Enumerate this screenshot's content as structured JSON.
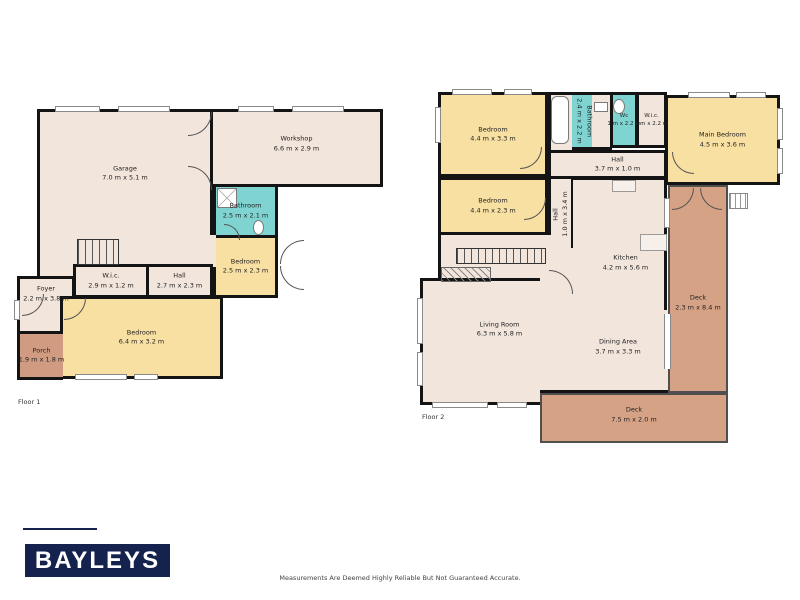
{
  "branding": {
    "logo": "BAYLEYS"
  },
  "disclaimer": "Measurements Are Deemed Highly Reliable But Not Guaranteed Accurate.",
  "colors": {
    "floor": "#f2e5dc",
    "bedroom": "#f8dfa2",
    "bath": "#7fd4d1",
    "porch": "#d09b80",
    "deck": "#d6a285",
    "wall": "#141414",
    "deck_wall": "#4f4f4f",
    "logo_bg": "#14224d"
  },
  "floors": [
    {
      "label": "Floor 1",
      "label_pos": [
        18,
        398
      ],
      "rooms": [
        {
          "name": "Garage",
          "dims": "7.0 m x 5.1 m",
          "fill": "floor",
          "rect": [
            37,
            109,
            176,
            129
          ]
        },
        {
          "name": "Workshop",
          "dims": "6.6 m x 2.9 m",
          "fill": "floor",
          "rect": [
            210,
            109,
            173,
            78
          ],
          "dy": -4
        },
        {
          "name": "Bathroom",
          "dims": "2.5 m x 2.1 m",
          "fill": "bath",
          "rect": [
            213,
            184,
            65,
            54
          ]
        },
        {
          "name": "Bedroom",
          "dims": "2.5 m x 2.3 m",
          "fill": "bedroom",
          "rect": [
            213,
            235,
            65,
            63
          ]
        },
        {
          "name": "",
          "dims": "",
          "fill": "floor",
          "rect": [
            37,
            235,
            179,
            32
          ],
          "sides": "l"
        },
        {
          "name": "",
          "dims": "",
          "fill": "floor",
          "rect": [
            37,
            264,
            39,
            36
          ],
          "sides": "l"
        },
        {
          "name": "W.i.c.",
          "dims": "2.9 m x 1.2 m",
          "fill": "floor",
          "rect": [
            73,
            264,
            76,
            34
          ]
        },
        {
          "name": "Hall",
          "dims": "2.7 m x 2.3 m",
          "fill": "floor",
          "rect": [
            146,
            264,
            67,
            34
          ]
        },
        {
          "name": "Foyer",
          "dims": "2.2 m x 3.8 m",
          "fill": "floor",
          "rect": [
            17,
            276,
            58,
            58
          ],
          "dy": -11
        },
        {
          "name": "Bedroom",
          "dims": "6.4 m x 3.2 m",
          "fill": "bedroom",
          "rect": [
            60,
            296,
            163,
            83
          ]
        },
        {
          "name": "Porch",
          "dims": "1.9 m x 1.8 m",
          "fill": "porch",
          "rect": [
            17,
            331,
            46,
            49
          ],
          "sides": "ltb"
        }
      ]
    },
    {
      "label": "Floor 2",
      "label_pos": [
        422,
        413
      ],
      "rooms": [
        {
          "name": "Bedroom",
          "dims": "4.4 m x 3.3 m",
          "fill": "bedroom",
          "rect": [
            438,
            92,
            110,
            85
          ]
        },
        {
          "name": "",
          "dims": "",
          "fill": "floor",
          "rect": [
            548,
            92,
            27,
            58
          ],
          "sides": "tl"
        },
        {
          "name": "Bathroom",
          "dims": "2.4 m x 2.2 m",
          "fill": "bath",
          "rect": [
            572,
            92,
            23,
            58
          ],
          "sides": "tb",
          "vertical": true
        },
        {
          "name": "",
          "dims": "",
          "fill": "floor",
          "rect": [
            592,
            92,
            20,
            58
          ],
          "sides": "tb"
        },
        {
          "name": "Wc",
          "dims": "1 m x 2.2 m",
          "fill": "bath",
          "rect": [
            610,
            92,
            28,
            56
          ],
          "small": true
        },
        {
          "name": "W.i.c.",
          "dims": "1 m x 2.2 m",
          "fill": "floor",
          "rect": [
            636,
            92,
            31,
            56
          ],
          "small": true
        },
        {
          "name": "Main Bedroom",
          "dims": "4.5 m x 3.6 m",
          "fill": "bedroom",
          "rect": [
            665,
            95,
            115,
            90
          ]
        },
        {
          "name": "Hall",
          "dims": "3.7 m x 1.0 m",
          "fill": "floor",
          "rect": [
            548,
            150,
            119,
            29
          ],
          "dx": 10
        },
        {
          "name": "Bedroom",
          "dims": "4.4 m x 2.3 m",
          "fill": "bedroom",
          "rect": [
            438,
            177,
            110,
            58
          ]
        },
        {
          "name": "Hall",
          "dims": "1.0 m x 3.4 m",
          "fill": "floor",
          "rect": [
            548,
            179,
            26,
            70
          ],
          "sides": "lr",
          "vertical": true,
          "flip": true
        },
        {
          "name": "Kitchen",
          "dims": "4.2 m x 5.6 m",
          "fill": "floor",
          "rect": [
            573,
            177,
            94,
            133
          ],
          "sides": "tr",
          "dx": 7,
          "dy": 18
        },
        {
          "name": "",
          "dims": "",
          "fill": "floor",
          "rect": [
            438,
            235,
            113,
            45
          ],
          "sides": "l"
        },
        {
          "name": "",
          "dims": "",
          "fill": "floor",
          "rect": [
            540,
            248,
            36,
            64
          ],
          "sides": ""
        },
        {
          "name": "Living Room",
          "dims": "6.3 m x 5.8 m",
          "fill": "floor",
          "rect": [
            420,
            278,
            120,
            127
          ],
          "sides": "tlb",
          "dx": 18,
          "dy": -12
        },
        {
          "name": "Dining Area",
          "dims": "3.7 m x 3.3 m",
          "fill": "floor",
          "rect": [
            540,
            310,
            128,
            83
          ],
          "sides": "b",
          "dx": 14,
          "dy": -3
        },
        {
          "name": "Deck",
          "dims": "2.3 m x 8.4 m",
          "fill": "deck",
          "rect": [
            668,
            185,
            60,
            208
          ],
          "deck": true,
          "dy": 14
        },
        {
          "name": "Deck",
          "dims": "7.5 m x 2.0 m",
          "fill": "deck",
          "rect": [
            540,
            393,
            188,
            50
          ],
          "deck": true,
          "dy": -3
        }
      ]
    }
  ]
}
